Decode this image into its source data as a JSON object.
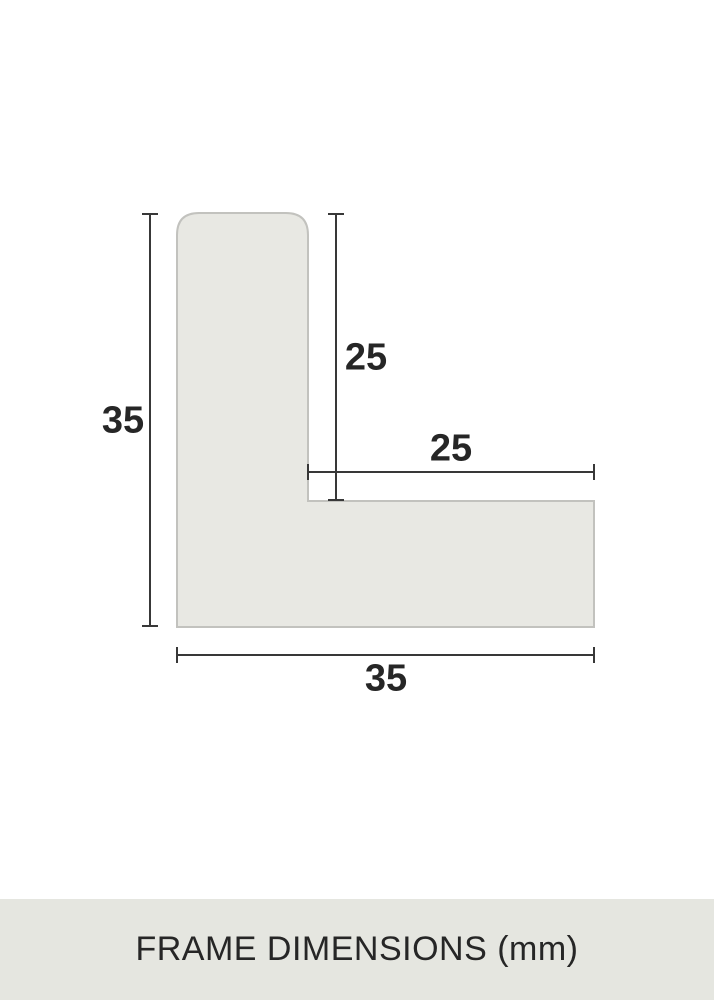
{
  "diagram": {
    "kind": "frame-moulding-cross-section",
    "unit": "mm",
    "dimensions": {
      "overall_height": "35",
      "overall_width": "35",
      "inner_height": "25",
      "inner_width": "25"
    }
  },
  "caption": {
    "text": "FRAME DIMENSIONS (mm)"
  },
  "colors": {
    "bg": "#ffffff",
    "panel": "#e5e6e0",
    "shape-fill": "#e8e8e3",
    "shape-stroke": "#c2c2be",
    "line": "#383838",
    "ink": "#262626"
  }
}
